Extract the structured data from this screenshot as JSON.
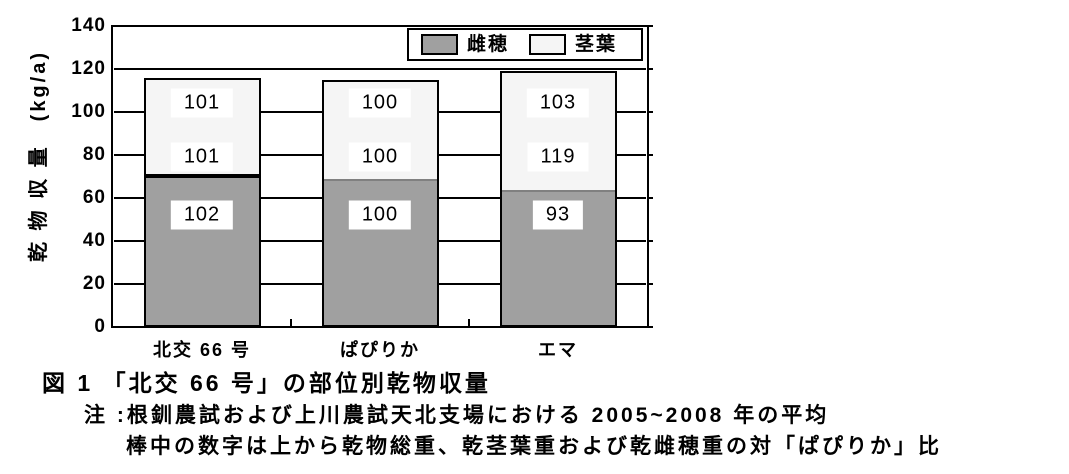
{
  "figure": {
    "title": "図 1 「北交 66 号」の部位別乾物収量",
    "note_line1": "注 :根釧農試および上川農試天北支場における 2005~2008 年の平均",
    "note_line2": "棒中の数字は上から乾物総重、乾茎葉重および乾雌穂重の対「ぱぴりか」比"
  },
  "chart_data": {
    "type": "bar",
    "subtype": "stacked",
    "categories": [
      "北交 66 号",
      "ぱぴりか",
      "エマ"
    ],
    "series": [
      {
        "name": "雌穂",
        "color": "#a0a0a0",
        "values": [
          70,
          68,
          63
        ]
      },
      {
        "name": "茎葉",
        "color": "#f5f5f5",
        "values": [
          46,
          47,
          56
        ]
      }
    ],
    "bar_labels_top_to_bottom": [
      [
        "101",
        "101",
        "102"
      ],
      [
        "100",
        "100",
        "100"
      ],
      [
        "103",
        "119",
        "93"
      ]
    ],
    "ylabel": "乾物収量 (kg/a)",
    "ylabel_display": "乾 物 収 量　(kg/a)",
    "ylim": [
      0,
      140
    ],
    "ytick_step": 20,
    "grid": true,
    "legend": {
      "position": "top-right-inside",
      "entries": [
        "雌穂",
        "茎葉"
      ]
    },
    "colors": {
      "ear_fill": "#a0a0a0",
      "stem_fill": "#f5f5f5",
      "axis": "#000000",
      "label_bg": "#ffffff",
      "segment_divider_first": "#000000",
      "segment_divider_rest": "#808080"
    }
  }
}
